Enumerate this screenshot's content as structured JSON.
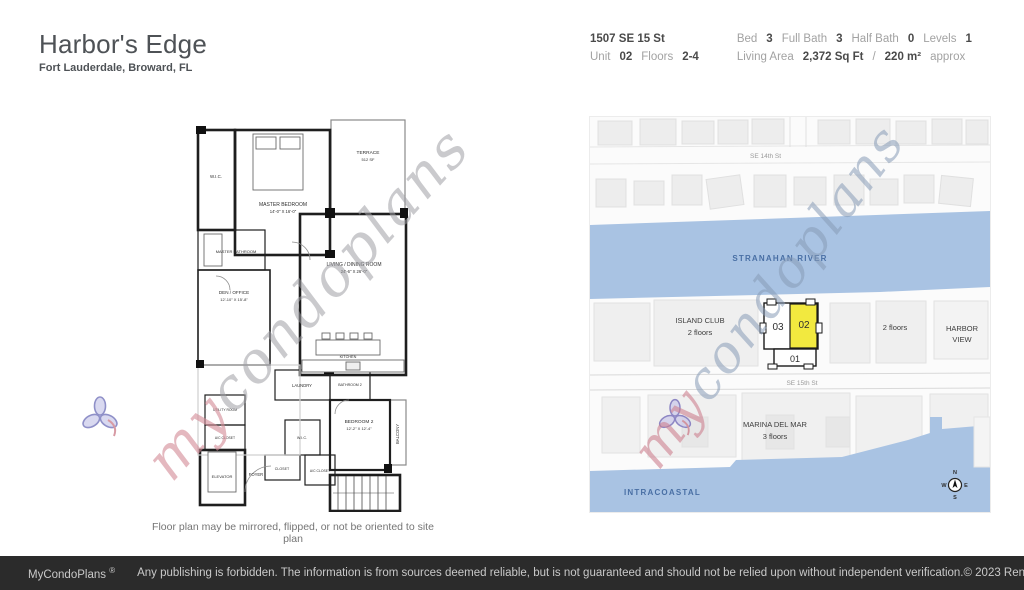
{
  "header": {
    "title": "Harbor's Edge",
    "subtitle": "Fort Lauderdale, Broward, FL",
    "address": "1507 SE 15 St",
    "unit_label": "Unit",
    "unit_value": "02",
    "floors_label": "Floors",
    "floors_value": "2-4",
    "bed_label": "Bed",
    "bed_value": "3",
    "full_bath_label": "Full Bath",
    "full_bath_value": "3",
    "half_bath_label": "Half Bath",
    "half_bath_value": "0",
    "levels_label": "Levels",
    "levels_value": "1",
    "living_area_label": "Living Area",
    "living_area_value": "2,372 Sq Ft",
    "living_area_sep": "/",
    "living_area_metric": "220 m²",
    "living_area_suffix": "approx"
  },
  "floor_plan": {
    "caption": "Floor plan may be mirrored, flipped, or not be oriented to site plan",
    "rooms": {
      "wic": {
        "name": "W.I.C."
      },
      "master_bedroom": {
        "name": "MASTER BEDROOM",
        "dims": "14'-0\" X 16'-0\""
      },
      "terrace": {
        "name": "TERRACE",
        "dims": "512 SF"
      },
      "master_bathroom": {
        "name": "MASTER BATHROOM"
      },
      "den_office": {
        "name": "DEN / OFFICE",
        "dims": "12'-10\" X 15'-8\""
      },
      "living_dining": {
        "name": "LIVING / DINING ROOM",
        "dims": "24'-6\" X 26'-0\""
      },
      "kitchen": {
        "name": "KITCHEN"
      },
      "laundry": {
        "name": "LAUNDRY"
      },
      "bathroom2": {
        "name": "BATHROOM 2"
      },
      "bedroom2": {
        "name": "BEDROOM 2",
        "dims": "12'-2\" X 12'-4\""
      },
      "balcony": {
        "name": "BALCONY"
      },
      "utility": {
        "name": "UTILITY ROOM"
      },
      "ac_closet": {
        "name": "A/C CLOSET"
      },
      "elevator": {
        "name": "ELEVATOR"
      },
      "foyer": {
        "name": "FOYER"
      },
      "wic2": {
        "name": "W.I.C."
      },
      "closet": {
        "name": "CLOSET"
      },
      "ac_closet2": {
        "name": "A/C CLOSET"
      }
    }
  },
  "site_map": {
    "streets": {
      "se14": "SE 14th St",
      "se15": "SE 15th St"
    },
    "water": {
      "river": "STRANAHAN RIVER",
      "intracoastal": "INTRACOASTAL"
    },
    "buildings": {
      "island_club_name": "ISLAND CLUB",
      "island_club_floors": "2 floors",
      "unit_01": "01",
      "unit_02": "02",
      "unit_03": "03",
      "east_floors": "2 floors",
      "harbor_view_line1": "HARBOR",
      "harbor_view_line2": "VIEW",
      "marina_name": "MARINA DEL MAR",
      "marina_floors": "3 floors"
    },
    "compass": {
      "n": "N",
      "s": "S",
      "e": "E",
      "w": "W"
    },
    "colors": {
      "water": "#a9c3e3",
      "highlight": "#f2e93f"
    }
  },
  "watermark": {
    "part1": "my",
    "part2": "condoplans"
  },
  "footer": {
    "brand": "MyCondoPlans",
    "reg": "®",
    "disclaimer": "Any publishing is forbidden. The information is from sources deemed reliable, but is not guaranteed and should not be relied upon without independent verification.",
    "copyright": "© 2023 Renaissance Trading Corp  All Rights Reserved"
  }
}
